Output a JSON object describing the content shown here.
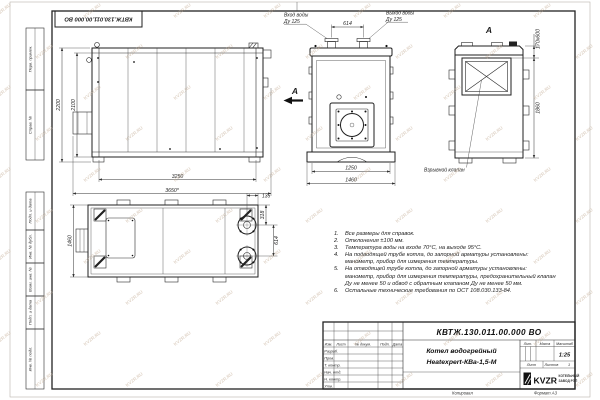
{
  "sheet": {
    "stamp_code": "КВТЖ.130.011.00.000 ВО",
    "margin_columns": [
      "Перв. примен.",
      "Справ. №",
      "Подп. и дата",
      "Инв. № дубл.",
      "Взам. инв. №",
      "Подп. и дата",
      "Инв. № подл."
    ],
    "footer_left": "Копировал",
    "footer_right": "Формат А3"
  },
  "views": {
    "side": {
      "dim_height_outer": "2200",
      "dim_height_inner": "2100",
      "dim_length_inner": "3250",
      "dim_length_outer": "3650*"
    },
    "front": {
      "inlet_label": "Вход воды",
      "inlet_dn": "Ду 125",
      "outlet_label": "Выход воды",
      "outlet_dn": "Ду 125",
      "dim_pipe_spacing": "614",
      "dim_width_inner": "1250",
      "dim_width_outer": "1460",
      "view_arrow_label": "А"
    },
    "view_a": {
      "label": "А",
      "dim_valve": "170x600",
      "dim_height": "1860",
      "valve_callout": "Взрывной клапан"
    },
    "top": {
      "dim_depth": "1460",
      "dim_edge": "135",
      "dim_flange_offset": "318",
      "dim_flange_spacing": "614"
    }
  },
  "notes": {
    "items": [
      {
        "n": "1.",
        "text": "Все размеры для справок."
      },
      {
        "n": "2.",
        "text": "Отклонения ±100 мм."
      },
      {
        "n": "3.",
        "text": "Температура воды на входе 70°С, на выходе 95°С."
      },
      {
        "n": "4.",
        "text": "На подводящей трубе котла, до запорной арматуры установлены: манометр, прибор для измерения температуры."
      },
      {
        "n": "5.",
        "text": "На отводящей трубе котла, до запорной арматуры установлены: манометр, прибор для измерения температуры, предохранительный клапан Ду не менее 50 и обвод с обратным клапаном Ду не менее 50 мм."
      },
      {
        "n": "6.",
        "text": "Остальные технические требования по ОСТ 108.030.133-84."
      }
    ]
  },
  "title_block": {
    "doc_number": "КВТЖ.130.011.00.000 ВО",
    "product_line1": "Котел водогрейный",
    "product_line2": "Heatexpert-КВа-1,5-М",
    "col_headers": {
      "izm": "Изм.",
      "list": "Лист",
      "doc": "№ докум.",
      "podp": "Подп.",
      "data": "Дата"
    },
    "role_rows": [
      "Разраб.",
      "Пров.",
      "Т. контр.",
      "Нач. отд.",
      "Н. контр.",
      "Утв."
    ],
    "lit_header": "Лит.",
    "mass_header": "Масса",
    "scale_header": "Масштаб",
    "scale_value": "1:25",
    "sheet_label": "Лист",
    "sheets_label": "Листов",
    "sheets_value": "1",
    "logo_text": "KVZR",
    "logo_caption1": "КОТЕЛЬНЫЙ",
    "logo_caption2": "ЗАВОД РЭП"
  },
  "watermark": {
    "text": "KVZR.RU"
  }
}
